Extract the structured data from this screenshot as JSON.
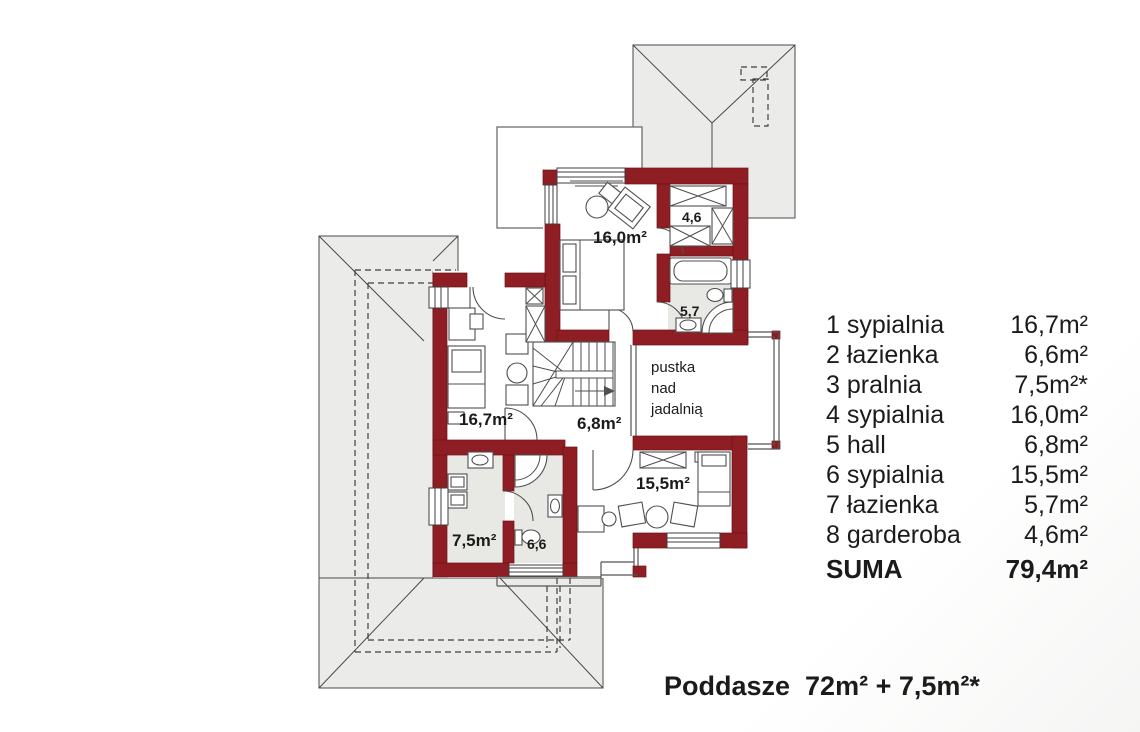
{
  "colors": {
    "wall": "#8e1e23",
    "roof": "#ebebe9",
    "floor": "#e8e8e5",
    "text": "#1b1b1b"
  },
  "plan": {
    "room_labels": {
      "bedroom4": "16,0m²",
      "garderoba": "4,6",
      "bathroom7": "5,7",
      "bedroom1": "16,7m²",
      "hall": "6,8m²",
      "bedroom6": "15,5m²",
      "pralnia": "7,5m²",
      "bathroom2": "6,6",
      "void_line1": "pustka",
      "void_line2": "nad",
      "void_line3": "jadalnią"
    }
  },
  "legend": {
    "rows": [
      {
        "label": "1 sypialnia",
        "area": "16,7m²"
      },
      {
        "label": "2 łazienka",
        "area": "6,6m²"
      },
      {
        "label": "3 pralnia",
        "area": "7,5m²*"
      },
      {
        "label": "4 sypialnia",
        "area": "16,0m²"
      },
      {
        "label": "5 hall",
        "area": "6,8m²"
      },
      {
        "label": "6 sypialnia",
        "area": "15,5m²"
      },
      {
        "label": "7 łazienka",
        "area": "5,7m²"
      },
      {
        "label": "8 garderoba",
        "area": "4,6m²"
      }
    ],
    "total_label": "SUMA",
    "total_value": "79,4m²"
  },
  "footer": {
    "text": "Poddasze  72m² + 7,5m²*"
  }
}
